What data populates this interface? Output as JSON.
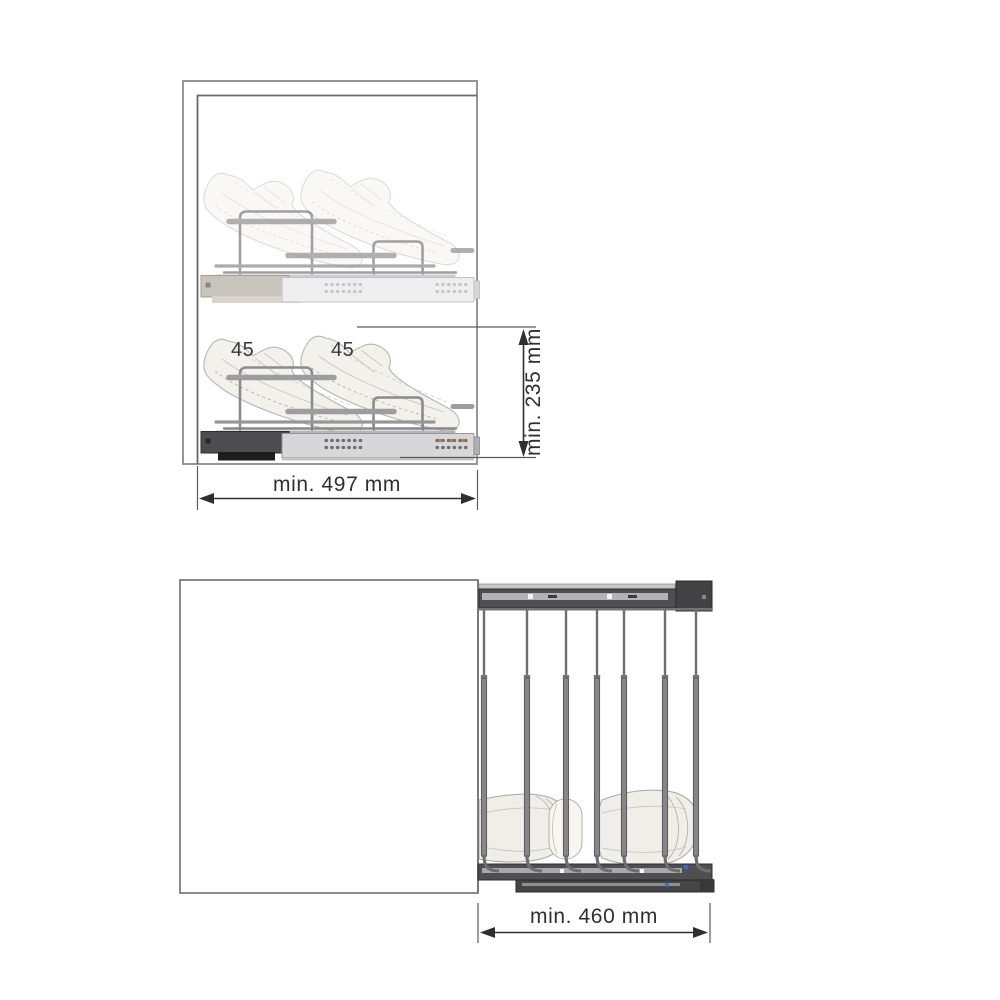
{
  "side_view": {
    "description": "side view of cabinet with two pull-out shoe shelves",
    "shoe_size_labels": [
      "45",
      "45"
    ],
    "width_dimension": "min. 497 mm",
    "height_dimension": "min. 235 mm"
  },
  "top_view": {
    "description": "top view of cabinet with pull-out shoe rack extended",
    "depth_dimension": "min. 460 mm"
  },
  "colors": {
    "background": "#ffffff",
    "dimension_line": "#2f2f31",
    "cabinet_line": "#7e7e80",
    "wire_gray": "#8b8b8d",
    "rail_dark": "#4f4f51",
    "drawer_light": "#d7d7d9",
    "shoe_ghost_fill": "#f2f1eb",
    "accent_dot_orange": "#b07f42",
    "accent_dot_blue": "#3f6bc9"
  }
}
